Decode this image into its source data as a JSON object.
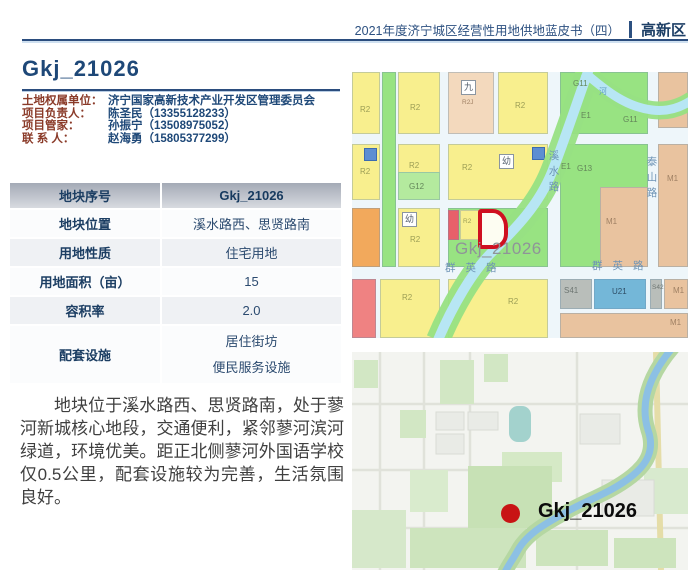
{
  "header": {
    "booklet_title": "2021年度济宁城区经营性用地供地蓝皮书（四）",
    "district": "高新区"
  },
  "parcel_title": "Gkj_21026",
  "contacts": [
    {
      "label": "土地权属单位：",
      "value": "济宁国家高新技术产业开发区管理委员会"
    },
    {
      "label": "项目负责人：",
      "value": "陈圣民（13355128233）"
    },
    {
      "label": "项目管家：",
      "value": "孙振宁（13508975052）"
    },
    {
      "label": "联 系 人：",
      "value": "赵海勇（15805377299）"
    }
  ],
  "info_table": {
    "header": {
      "label": "地块序号",
      "value": "Gkj_21026"
    },
    "rows": [
      {
        "label": "地块位置",
        "value": "溪水路西、思贤路南"
      },
      {
        "label": "用地性质",
        "value": "住宅用地"
      },
      {
        "label": "用地面积（亩）",
        "value": "15"
      },
      {
        "label": "容积率",
        "value": "2.0"
      },
      {
        "label": "配套设施",
        "value": "居住街坊",
        "value2": "便民服务设施"
      }
    ]
  },
  "description": "地块位于溪水路西、思贤路南，处于蓼河新城核心地段，交通便利，紧邻蓼河滨河绿道，环境优美。距正北侧蓼河外国语学校仅0.5公里，配套设施较为完善，生活氛围良好。",
  "zoning_map": {
    "labels": [
      {
        "t": "R2",
        "x": 8,
        "y": 34,
        "c": "c-y"
      },
      {
        "t": "R2",
        "x": 58,
        "y": 32,
        "c": "c-y"
      },
      {
        "t": "九",
        "x": 109,
        "y": 8,
        "c": "box"
      },
      {
        "t": "R2J",
        "x": 110,
        "y": 28,
        "c": "c-t c-xs"
      },
      {
        "t": "R2",
        "x": 163,
        "y": 30,
        "c": "c-y"
      },
      {
        "t": "G11",
        "x": 221,
        "y": 8,
        "c": "c-g"
      },
      {
        "t": "河",
        "x": 247,
        "y": 16,
        "c": "c-r"
      },
      {
        "t": "E1",
        "x": 229,
        "y": 40,
        "c": "c-g"
      },
      {
        "t": "G11",
        "x": 271,
        "y": 44,
        "c": "c-g"
      },
      {
        "t": "R2",
        "x": 8,
        "y": 96,
        "c": "c-y"
      },
      {
        "t": "R2",
        "x": 57,
        "y": 90,
        "c": "c-y"
      },
      {
        "t": "G12",
        "x": 57,
        "y": 111,
        "c": "c-g"
      },
      {
        "t": "R2",
        "x": 110,
        "y": 92,
        "c": "c-y"
      },
      {
        "t": "幼",
        "x": 147,
        "y": 82,
        "c": "box"
      },
      {
        "t": "E1",
        "x": 209,
        "y": 91,
        "c": "c-g"
      },
      {
        "t": "G13",
        "x": 225,
        "y": 93,
        "c": "c-g"
      },
      {
        "t": "M1",
        "x": 315,
        "y": 103,
        "c": "c-t"
      },
      {
        "t": "M1",
        "x": 254,
        "y": 146,
        "c": "c-t"
      },
      {
        "t": "泰山路",
        "x": 294,
        "y": 84,
        "c": "road vert"
      },
      {
        "t": "溪水路",
        "x": 196,
        "y": 78,
        "c": "road vert"
      },
      {
        "t": "幼",
        "x": 50,
        "y": 140,
        "c": "box"
      },
      {
        "t": "R2",
        "x": 58,
        "y": 164,
        "c": "c-y"
      },
      {
        "t": "R2",
        "x": 111,
        "y": 147,
        "c": "c-y c-xs"
      },
      {
        "t": "Gkj_21026",
        "x": 103,
        "y": 168,
        "c": "target-lbl"
      },
      {
        "t": "群英路",
        "x": 93,
        "y": 191,
        "c": "road"
      },
      {
        "t": "群英路",
        "x": 240,
        "y": 189,
        "c": "road"
      },
      {
        "t": "R2",
        "x": 50,
        "y": 222,
        "c": "c-y"
      },
      {
        "t": "R2",
        "x": 156,
        "y": 226,
        "c": "c-y"
      },
      {
        "t": "S41",
        "x": 212,
        "y": 215,
        "c": "c-gray"
      },
      {
        "t": "U21",
        "x": 260,
        "y": 216,
        "c": "c-b"
      },
      {
        "t": "S42",
        "x": 300,
        "y": 213,
        "c": "c-gray c-xs"
      },
      {
        "t": "M1",
        "x": 321,
        "y": 215,
        "c": "c-t"
      },
      {
        "t": "M1",
        "x": 318,
        "y": 247,
        "c": "c-t"
      }
    ]
  },
  "location_map": {
    "marker_label": "Gkj_21026"
  },
  "colors": {
    "accent_navy": "#2b4d7e",
    "contact_label_maroon": "#8a3a28",
    "table_header_gray": "#a4aab6",
    "target_parcel_red": "#cf1020",
    "marker_red": "#c81414"
  }
}
